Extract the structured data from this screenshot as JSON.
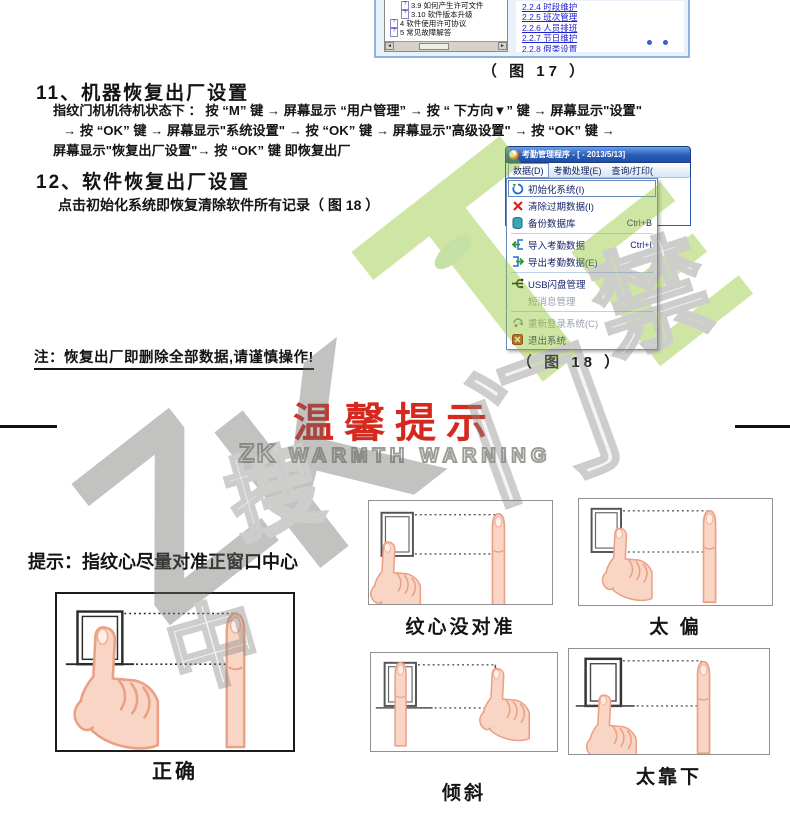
{
  "figure17": {
    "tree": [
      "3.9 如何产生许可文件",
      "3.10 软件版本升级",
      "4 软件使用许可协议",
      "5 常见故障解答"
    ],
    "links": [
      "2.2.4 时段维护",
      "2.2.5 班次管理",
      "2.2.6 人员排班",
      "2.2.7 节日维护",
      "2.2.8 假类设置"
    ],
    "caption": "（ 图 17 ）"
  },
  "section11": {
    "title": "11、机器恢复出厂设置",
    "line1": "指纹门机机待机状态下 ：  按  “M” 键  →   屏幕显示 “用户管理” →  按 “ 下方向▼” 键  →   屏幕显示\"设置\"",
    "line2": "→   按 “OK” 键   →   屏幕显示\"系统设置\"   →   按 “OK” 键 →   屏幕显示\"高级设置\"  →   按 “OK” 键    →",
    "line3": "屏幕显示\"恢复出厂设置\"→   按 “OK” 键  即恢复出厂"
  },
  "section12": {
    "title": "12、软件恢复出厂设置",
    "body": "点击初始化系统即恢复清除软件所有记录（ 图 18 ）"
  },
  "figure18": {
    "window_title": "考勤管理程序 - [ - 2013/5/13]",
    "menus": [
      "数据(D)",
      "考勤处理(E)",
      "查询/打印("
    ],
    "items": [
      {
        "label": "初始化系统(I)",
        "shortcut": ""
      },
      {
        "label": "清除过期数据(I)",
        "shortcut": ""
      },
      {
        "label": "备份数据库",
        "shortcut": "Ctrl+B"
      },
      {
        "label": "导入考勤数据",
        "shortcut": "Ctrl+I"
      },
      {
        "label": "导出考勤数据(E)",
        "shortcut": ""
      },
      {
        "label": "USB闪盘管理",
        "shortcut": ""
      },
      {
        "label": "短消息管理",
        "shortcut": ""
      },
      {
        "label": "重新登录系统(C)",
        "shortcut": ""
      },
      {
        "label": "退出系统",
        "shortcut": ""
      }
    ],
    "caption": "（ 图 18 ）"
  },
  "note": "注：恢复出厂即删除全部数据,请谨慎操作!",
  "warning": {
    "title": "温馨提示",
    "brand": "ZK",
    "subtitle": "WARMTH WARNING"
  },
  "tip": "提示：指纹心尽量对准正窗口中心",
  "panels": [
    "正确",
    "纹心没对准",
    "太 偏",
    "倾斜",
    "太靠下"
  ],
  "watermark": {
    "l1": "Z",
    "l2": "K",
    "l3": "T",
    "l4": "E",
    "c1": "门",
    "c2": "禁",
    "c3": "搜",
    "c4": "中"
  },
  "colors": {
    "warning_red": "#d5291f",
    "brand_green": "#8fc325",
    "link_blue": "#1f1fd0",
    "menu_navy": "#18246a"
  }
}
